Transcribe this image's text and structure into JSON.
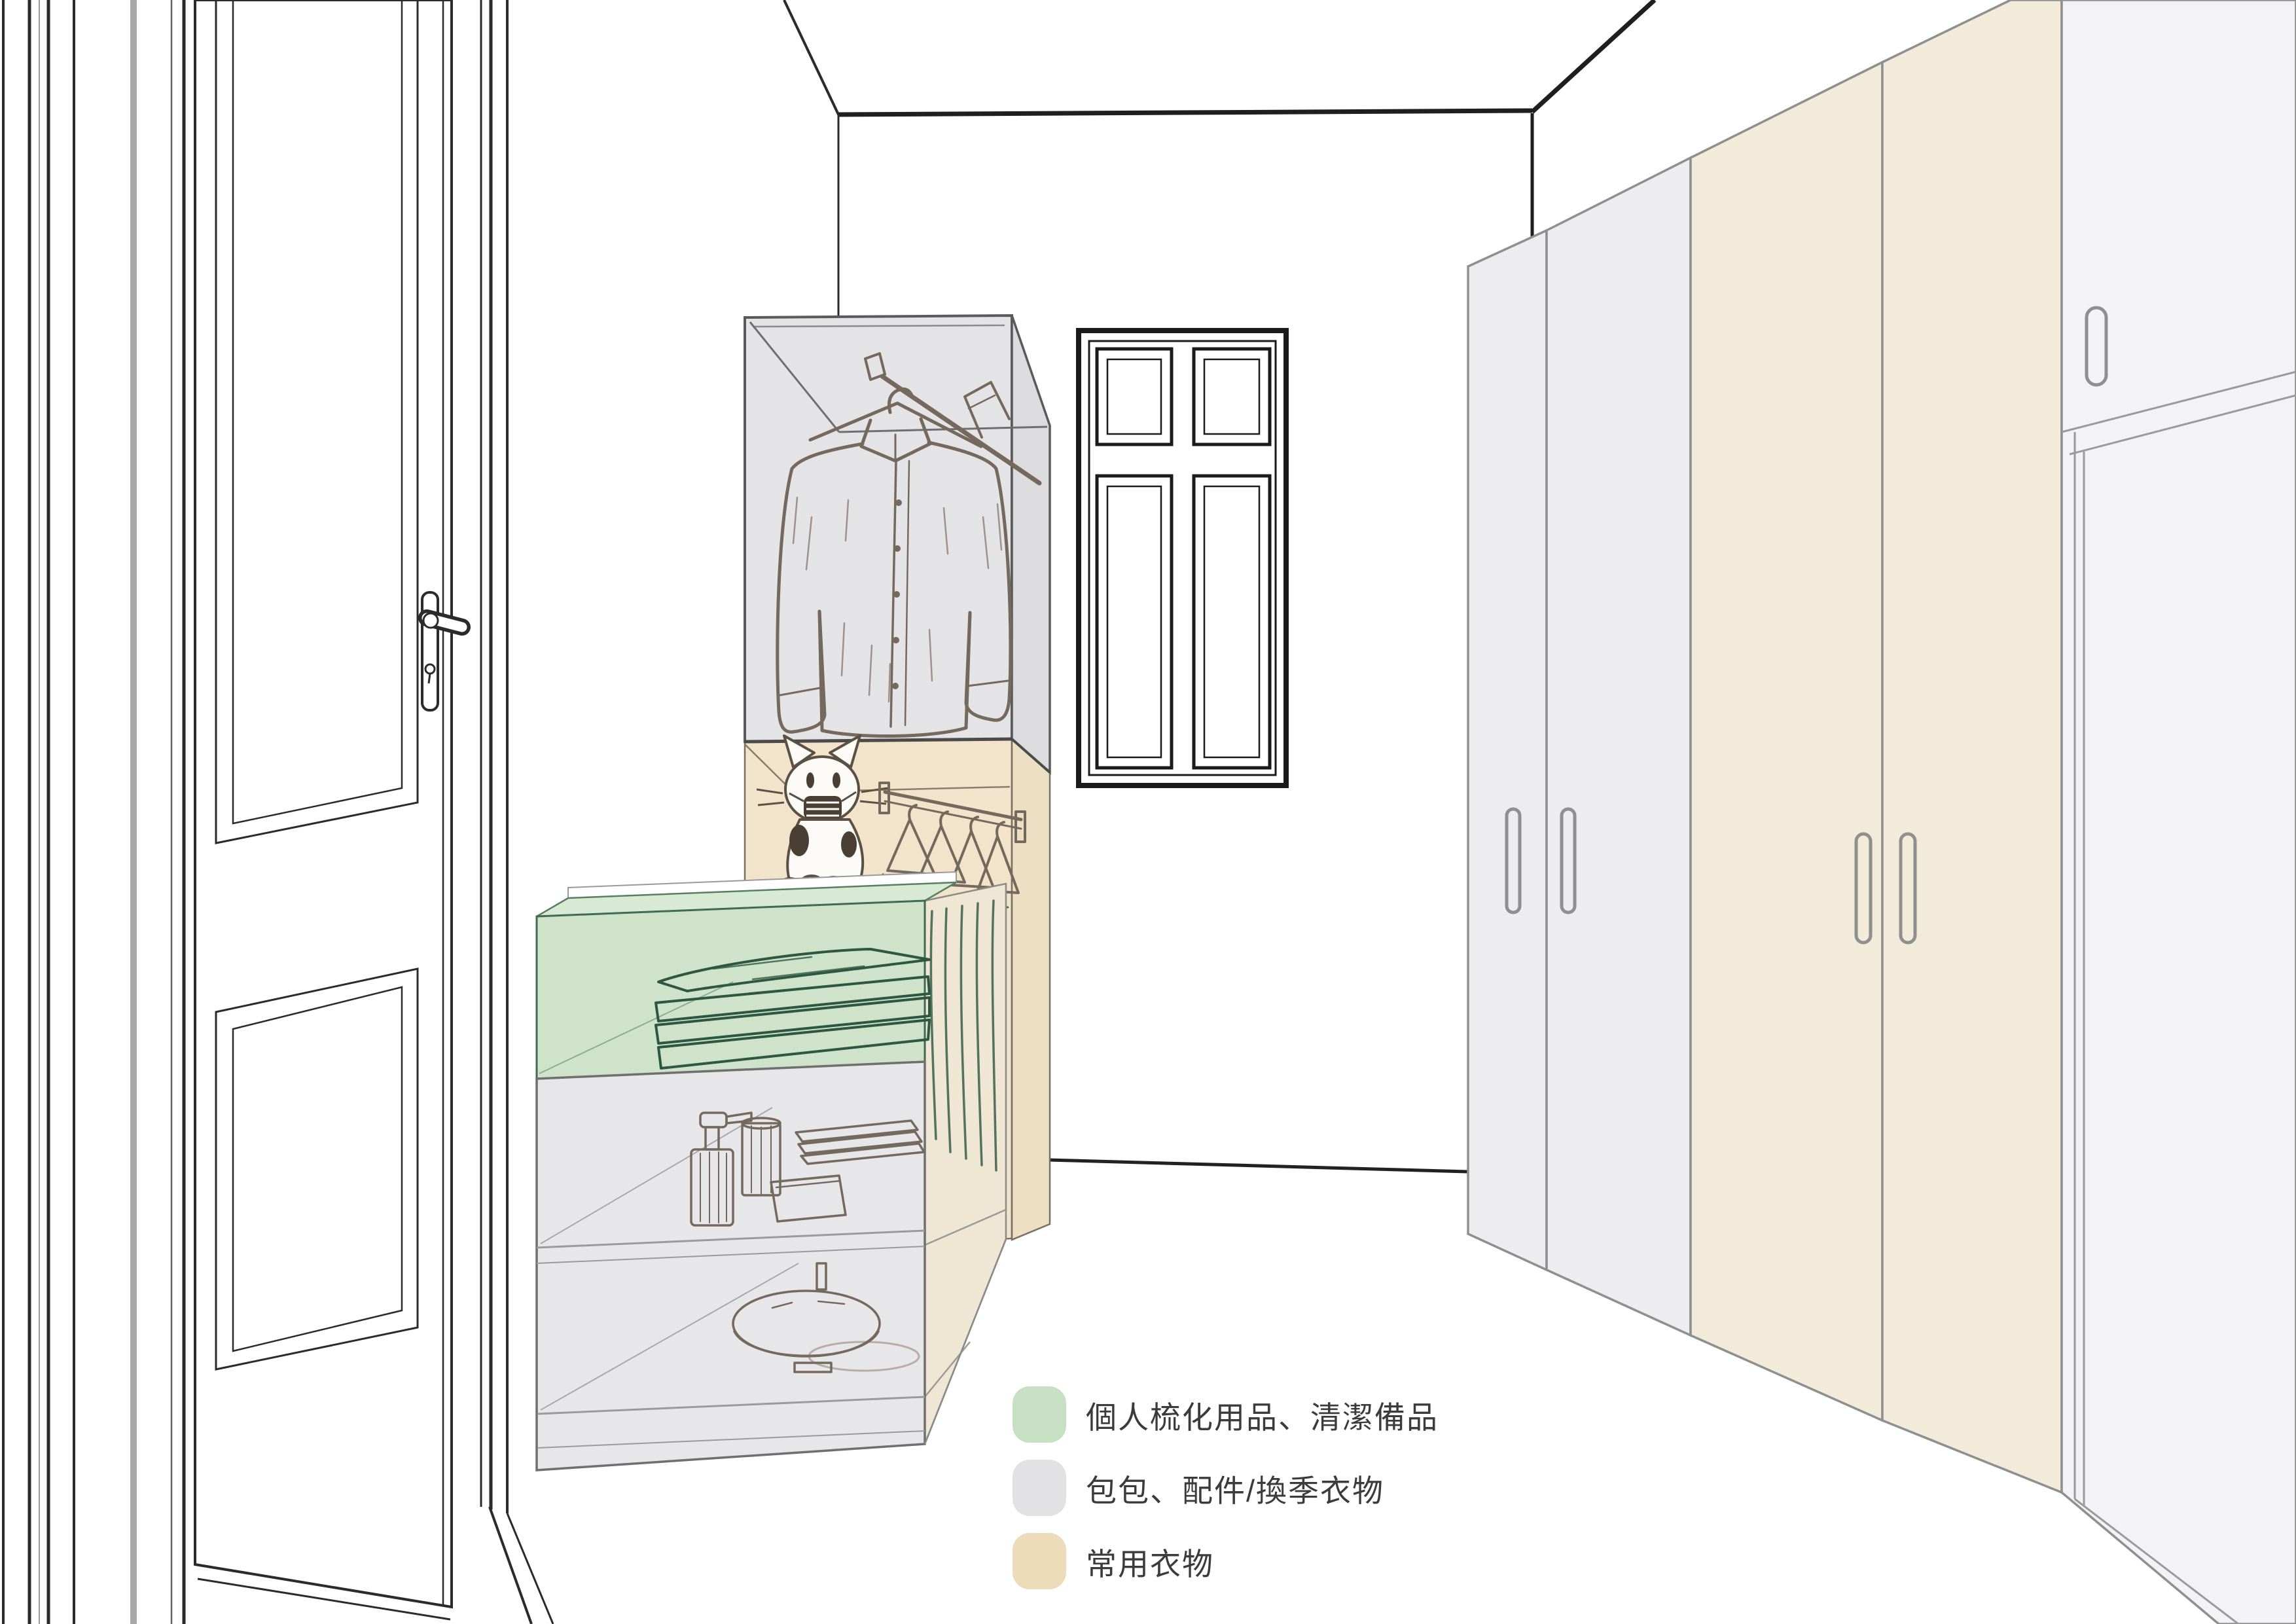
{
  "legend": {
    "items": [
      {
        "id": "green",
        "label": "個人梳化用品、清潔備品",
        "color": "#c7dfc2"
      },
      {
        "id": "gray",
        "label": "包包、配件/換季衣物",
        "color": "#e2e2e5"
      },
      {
        "id": "beige",
        "label": "常用衣物",
        "color": "#ecdcba"
      }
    ]
  },
  "colors": {
    "zone_gray": "#e4e4e6",
    "zone_gray_side": "#dcdcdf",
    "zone_beige": "#f2e4ca",
    "zone_beige_side": "#ecdfc4",
    "zone_green": "#cfe3cb",
    "zone_green_top": "#d8e9d4",
    "zone_shelf_gray": "#e7e7e9",
    "zone_shelf_side": "#efe6d3",
    "wardrobe_gray": "#ededef",
    "wardrobe_beige": "#f2ebd9",
    "wardrobe_white": "#f3f3f5",
    "door_white": "#ffffff",
    "sketch_brown": "#75685c",
    "sketch_green": "#2d5741",
    "line_dark": "#2b2b2b",
    "line_gray": "#9a9a9a"
  }
}
